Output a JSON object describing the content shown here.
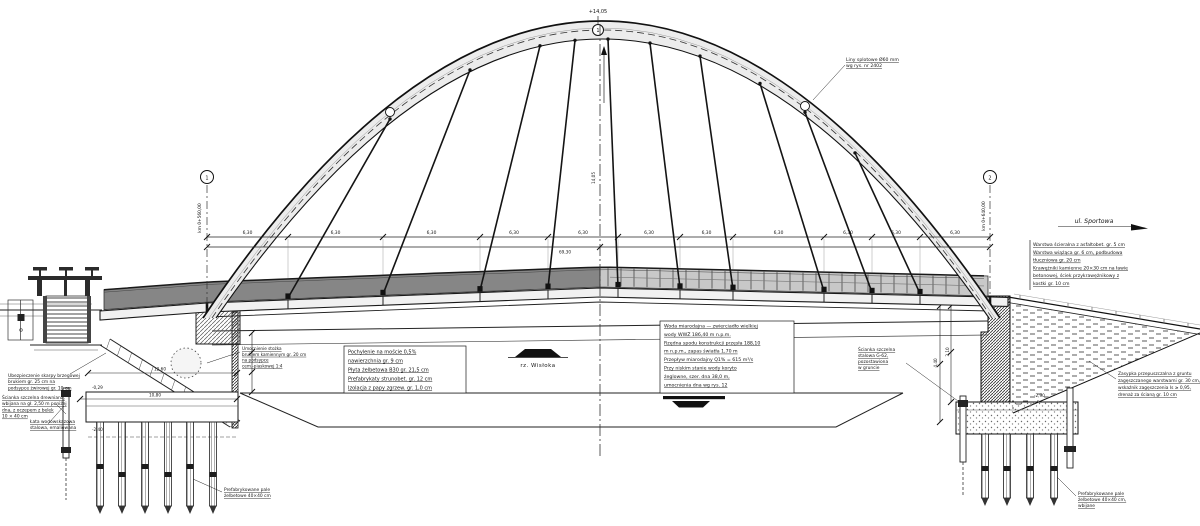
{
  "labels": {
    "river": "rz. Wisłoka",
    "street": "ul. Sportowa",
    "apex_elevation": "+14,05",
    "apex_node": "1",
    "rise": "14,05",
    "axis_left_node": "1",
    "axis_left_km": "km 0+560,00",
    "axis_right_node": "2",
    "axis_right_km": "km 0+640,00",
    "total_span": "69,30"
  },
  "dimensions": {
    "segments": [
      "6,30",
      "6,30",
      "6,30",
      "6,30",
      "6,30",
      "6,30",
      "6,30",
      "6,30",
      "6,30",
      "6,30",
      "6,30"
    ],
    "cap_upper": "12,60",
    "cap_lower": "10,80",
    "wall_height": "4,40",
    "wall_upper": "3,10",
    "elev_cap_top": "-0,29",
    "elev_cap_bottom": "-2,40",
    "elev_footing": "-2,90"
  },
  "notes": {
    "cable": [
      "Liny splotowe Ø60 mm",
      "wg rys. nr 2402"
    ],
    "deck_layers": [
      "Pochylenie na moście 0,5%",
      "nawierzchnia gr. 9 cm",
      "Płyta żelbetowa B30 gr. 21,5 cm",
      "Prefabrykaty strunobet. gr. 12 cm",
      "Izolacja z papy zgrzew. gr. 1,0 cm"
    ],
    "hydrology": [
      "Woda miarodajna — zwierciadło wielkiej",
      "wody WWŻ 186,40 m n.p.m.",
      "Rzędna spodu konstrukcji przęsła 188,10",
      "m n.p.m., zapas światła 1,70 m",
      "Przepływ miarodajny Q1% = 615 m³/s",
      "Przy niskim stanie wody koryto",
      "żeglowne, szer. dna 38,0 m,",
      "umocnienia dna wg rys. 12"
    ],
    "road_layers": [
      "Warstwa ścieralna z asfaltobet. gr. 5 cm",
      "Warstwa wiążąca gr. 6 cm, podbudowa",
      "tłuczniowa gr. 20 cm",
      "Krawężniki kamienne 20×30 cm na ławie",
      "betonowej, ściek przykrawężnikowy z",
      "kostki gr. 10 cm"
    ],
    "backfill": [
      "Zasypka przepuszczalna z gruntu",
      "zagęszczanego warstwami gr. 30 cm,",
      "wskaźnik zagęszczenia Is ≥ 0,95,",
      "drenaż za ścianą gr. 10 cm"
    ],
    "slope_left": [
      "Ubezpieczenie skarpy brzegowej",
      "brukiem gr. 25 cm na",
      "podsypce żwirowej gr. 10 cm"
    ],
    "sheetpile_left": [
      "Ścianka szczelna drewniana,",
      "wbijana na gł. 2,50 m poniżej",
      "dna, z oczepem z belek",
      "10 × 40 cm"
    ],
    "gauge": [
      "Łata wodowskazowa",
      "stalowa, emaliowana"
    ],
    "cone": [
      "Umocnienie stożka",
      "brukiem kamiennym gr. 20 cm",
      "na podsypce",
      "cem.-piaskowej 1:4"
    ],
    "sheetpile_right": [
      "Ścianka szczelna",
      "stalowa G-62,",
      "pozostawiona",
      "w gruncie"
    ],
    "piles_left": [
      "Prefabrykowane pale",
      "żelbetowe 40×40 cm"
    ],
    "piles_right": [
      "Prefabrykowane pale",
      "żelbetowe 40×40 cm,",
      "wbijane"
    ]
  }
}
